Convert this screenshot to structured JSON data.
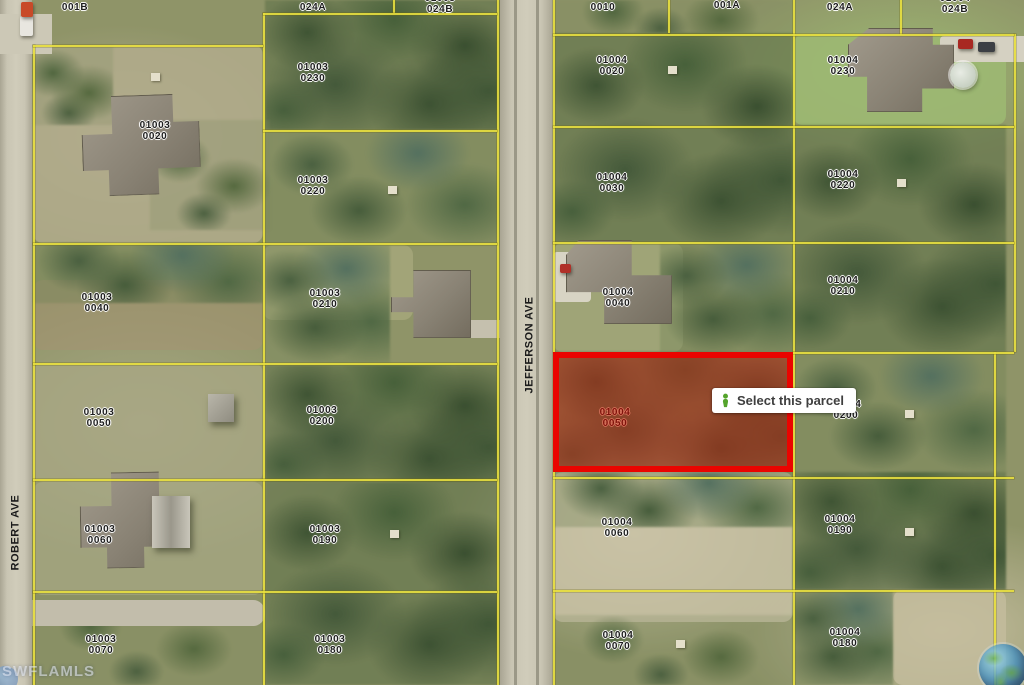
{
  "streets": {
    "jefferson": "JEFFERSON AVE",
    "robert": "ROBERT AVE"
  },
  "tooltip": {
    "label": "Select this parcel",
    "icon": "parcel-select-pin-icon",
    "icon_color": "#55a42c"
  },
  "watermark": {
    "mls": "SWFLAMLS",
    "globe_icon": "globe-earth-icon"
  },
  "selected_parcel": {
    "block": "01004",
    "lot": "0050",
    "border_color": "#ea0400",
    "fill_color": "rgba(196,38,20,0.52)"
  },
  "colors": {
    "parcel_line": "#e8df3e",
    "road": "#c9c5b3",
    "label_text": "#1d1d1d",
    "selected_label_text": "#7e130a"
  },
  "parcel_labels": [
    {
      "l1": "01003",
      "l2": "001B",
      "x": 75,
      "y": -9
    },
    {
      "l1": "01003",
      "l2": "024A",
      "x": 313,
      "y": -9
    },
    {
      "l1": "01003",
      "l2": "024B",
      "x": 440,
      "y": -7
    },
    {
      "l1": "01003",
      "l2": "0020",
      "x": 155,
      "y": 120
    },
    {
      "l1": "01003",
      "l2": "0230",
      "x": 313,
      "y": 62
    },
    {
      "l1": "01003",
      "l2": "0220",
      "x": 313,
      "y": 175
    },
    {
      "l1": "01003",
      "l2": "0040",
      "x": 97,
      "y": 292
    },
    {
      "l1": "01003",
      "l2": "0210",
      "x": 325,
      "y": 288
    },
    {
      "l1": "01003",
      "l2": "0050",
      "x": 99,
      "y": 407
    },
    {
      "l1": "01003",
      "l2": "0200",
      "x": 322,
      "y": 405
    },
    {
      "l1": "01003",
      "l2": "0060",
      "x": 100,
      "y": 524
    },
    {
      "l1": "01003",
      "l2": "0190",
      "x": 325,
      "y": 524
    },
    {
      "l1": "01003",
      "l2": "0070",
      "x": 101,
      "y": 634
    },
    {
      "l1": "01003",
      "l2": "0180",
      "x": 330,
      "y": 634
    },
    {
      "l1": "01004",
      "l2": "0010",
      "x": 603,
      "y": -9
    },
    {
      "l1": "01004",
      "l2": "001A",
      "x": 727,
      "y": -11
    },
    {
      "l1": "01004",
      "l2": "024A",
      "x": 840,
      "y": -9
    },
    {
      "l1": "01004",
      "l2": "024B",
      "x": 955,
      "y": -7
    },
    {
      "l1": "01004",
      "l2": "0020",
      "x": 612,
      "y": 55
    },
    {
      "l1": "01004",
      "l2": "0230",
      "x": 843,
      "y": 55
    },
    {
      "l1": "01004",
      "l2": "0030",
      "x": 612,
      "y": 172
    },
    {
      "l1": "01004",
      "l2": "0220",
      "x": 843,
      "y": 169
    },
    {
      "l1": "01004",
      "l2": "0040",
      "x": 618,
      "y": 287
    },
    {
      "l1": "01004",
      "l2": "0210",
      "x": 843,
      "y": 275
    },
    {
      "l1": "01004",
      "l2": "0050",
      "x": 615,
      "y": 407,
      "variant": "red"
    },
    {
      "l1": "01004",
      "l2": "0200",
      "x": 846,
      "y": 399
    },
    {
      "l1": "01004",
      "l2": "0060",
      "x": 617,
      "y": 517
    },
    {
      "l1": "01004",
      "l2": "0190",
      "x": 840,
      "y": 514
    },
    {
      "l1": "01004",
      "l2": "0070",
      "x": 618,
      "y": 630
    },
    {
      "l1": "01004",
      "l2": "0180",
      "x": 845,
      "y": 627
    }
  ]
}
